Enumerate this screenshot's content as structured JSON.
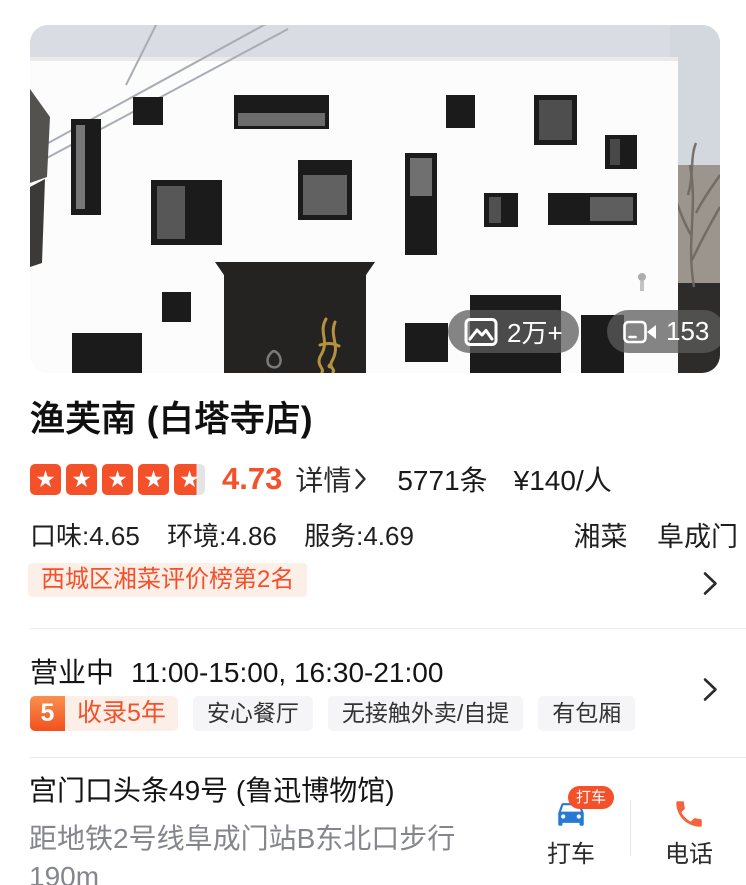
{
  "photo": {
    "photos_count": "2万+",
    "videos_count": "153"
  },
  "header": {
    "title": "渔芙南 (白塔寺店)"
  },
  "rating": {
    "stars_value": 4.73,
    "score": "4.73",
    "details_label": "详情",
    "reviews": "5771条",
    "price": "¥140/人",
    "taste": "口味:4.65",
    "environment": "环境:4.86",
    "service": "服务:4.69",
    "cuisine": "湘菜",
    "area": "阜成门",
    "rank": "西城区湘菜评价榜第2名"
  },
  "hours": {
    "status": "营业中",
    "schedule": "11:00-15:00, 16:30-21:00",
    "years_num": "5",
    "years_label": "收录5年",
    "tags": [
      "安心餐厅",
      "无接触外卖/自提",
      "有包厢"
    ]
  },
  "address": {
    "line1": "宫门口头条49号 (鲁迅博物馆)",
    "line2": "距地铁2号线阜成门站B东北口步行",
    "line3": "190m"
  },
  "actions": {
    "taxi_badge": "打车",
    "taxi_label": "打车",
    "phone_label": "电话"
  },
  "icons": {
    "star": "★"
  },
  "colors": {
    "accent": "#F4502A",
    "accent_bg": "#FCEFE8",
    "tag_bg": "#F5F5F7",
    "car_blue": "#2878D6",
    "phone_orange": "#F4633C",
    "star_empty": "#E4E4E6"
  }
}
